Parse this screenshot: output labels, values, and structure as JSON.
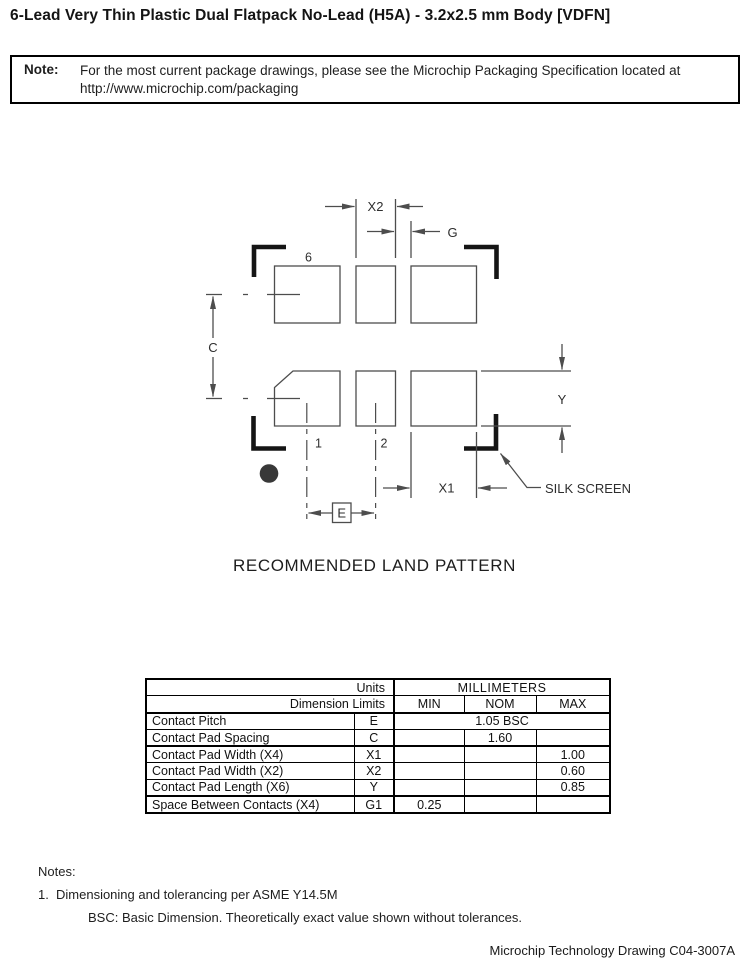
{
  "page": {
    "title": "6-Lead Very Thin Plastic Dual Flatpack No-Lead (H5A) - 3.2x2.5 mm Body [VDFN]",
    "note_box": {
      "label": "Note:",
      "line1": "For the most current package drawings, please see the Microchip Packaging Specification located at",
      "line2": "http://www.microchip.com/packaging"
    },
    "drawing": {
      "caption": "RECOMMENDED LAND PATTERN",
      "silk_screen_label": "SILK SCREEN",
      "pad_numbers": {
        "pin6": "6",
        "pin1": "1",
        "pin2": "2"
      },
      "dimension_labels": {
        "contact_pitch": "E",
        "pad_spacing": "C",
        "pad_width_x1": "X1",
        "pad_width_x2": "X2",
        "pad_length": "Y",
        "gap": "G"
      }
    },
    "table": {
      "header": {
        "units": "Units",
        "millimeters": "MILLIMETERS",
        "dimension_limits": "Dimension Limits",
        "min": "MIN",
        "nom": "NOM",
        "max": "MAX"
      },
      "rows": [
        {
          "name": "Contact Pitch",
          "symbol": "E",
          "span_value": "1.05 BSC"
        },
        {
          "name": "Contact Pad Spacing",
          "symbol": "C",
          "min": "",
          "nom": "1.60",
          "max": ""
        },
        {
          "name": "Contact Pad Width (X4)",
          "symbol": "X1",
          "min": "",
          "nom": "",
          "max": "1.00"
        },
        {
          "name": "Contact Pad Width (X2)",
          "symbol": "X2",
          "min": "",
          "nom": "",
          "max": "0.60"
        },
        {
          "name": "Contact Pad Length (X6)",
          "symbol": "Y",
          "min": "",
          "nom": "",
          "max": "0.85"
        },
        {
          "name": "Space Between Contacts (X4)",
          "symbol": "G1",
          "min": "0.25",
          "nom": "",
          "max": ""
        }
      ]
    },
    "notes": {
      "heading": "Notes:",
      "item1_number": "1.",
      "item1_text": "Dimensioning and tolerancing per ASME Y14.5M",
      "item1_sub": "BSC: Basic Dimension. Theoretically exact value shown without tolerances."
    },
    "footer": "Microchip Technology Drawing C04-3007A"
  },
  "colors": {
    "thin_line": "#4d4d4d",
    "silkscreen_bracket": "#151515",
    "pin1_dot": "#383838",
    "table_border": "#000000"
  }
}
